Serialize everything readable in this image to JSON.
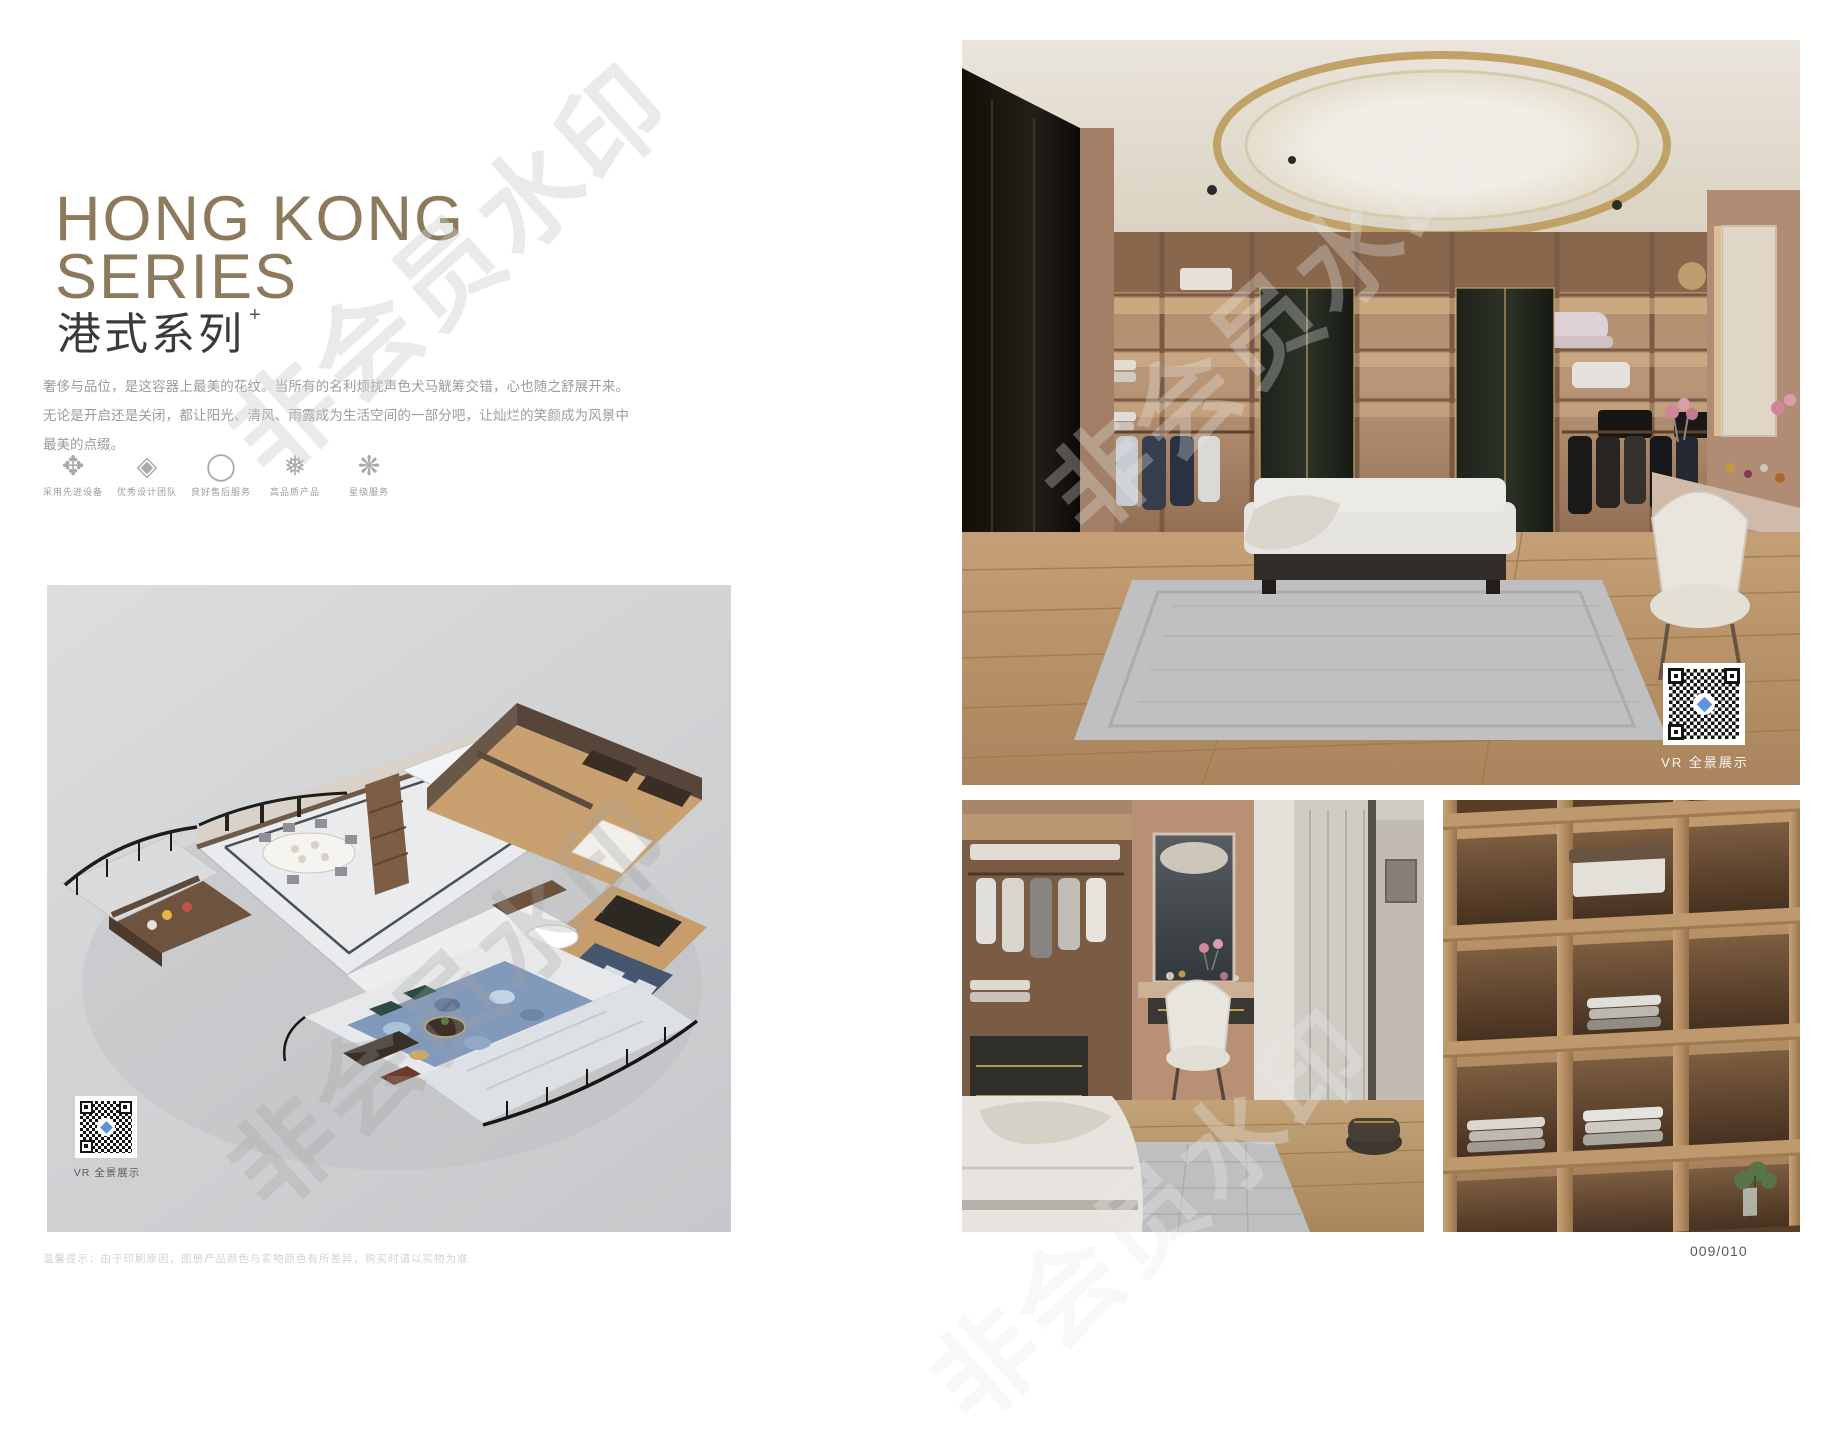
{
  "page": {
    "watermark": "非会员水印",
    "page_number": "009/010",
    "disclaimer": "温馨提示：由于印刷原因，图册产品颜色与实物颜色有所差异，购买时请以实物为准"
  },
  "header": {
    "title_line1": "HONG KONG",
    "title_line2": "SERIES",
    "subtitle": "港式系列",
    "subtitle_mark": "+",
    "description": "奢侈与品位，是这容器上最美的花纹。当所有的名利烦扰声色犬马觥筹交错，心也随之舒展开来。无论是开启还是关闭，都让阳光、清风、雨露成为生活空间的一部分吧，让灿烂的笑颜成为风景中最美的点缀。"
  },
  "features": {
    "items": [
      {
        "icon_name": "pinwheel-flower-icon",
        "icon": "✥",
        "label": "采用先进设备"
      },
      {
        "icon_name": "ornate-diamond-icon",
        "icon": "◈",
        "label": "优秀设计团队"
      },
      {
        "icon_name": "brush-ring-icon",
        "icon": "◯",
        "label": "良好售后服务"
      },
      {
        "icon_name": "snowflake-icon",
        "icon": "❅",
        "label": "高品质产品"
      },
      {
        "icon_name": "star-flake-icon",
        "icon": "❋",
        "label": "星级服务"
      }
    ]
  },
  "floorplan": {
    "vr_label": "VR 全景展示"
  },
  "gallery": {
    "main_vr_label": "VR 全景展示"
  },
  "colors": {
    "accent_gold": "#8d7a5c",
    "text_dark": "#3a3a3a",
    "text_gray": "#9b9b9b",
    "wood": "#b8926e",
    "panel_gray": "#d4d5d7",
    "ceiling_ring_gold": "#c9a96b"
  }
}
